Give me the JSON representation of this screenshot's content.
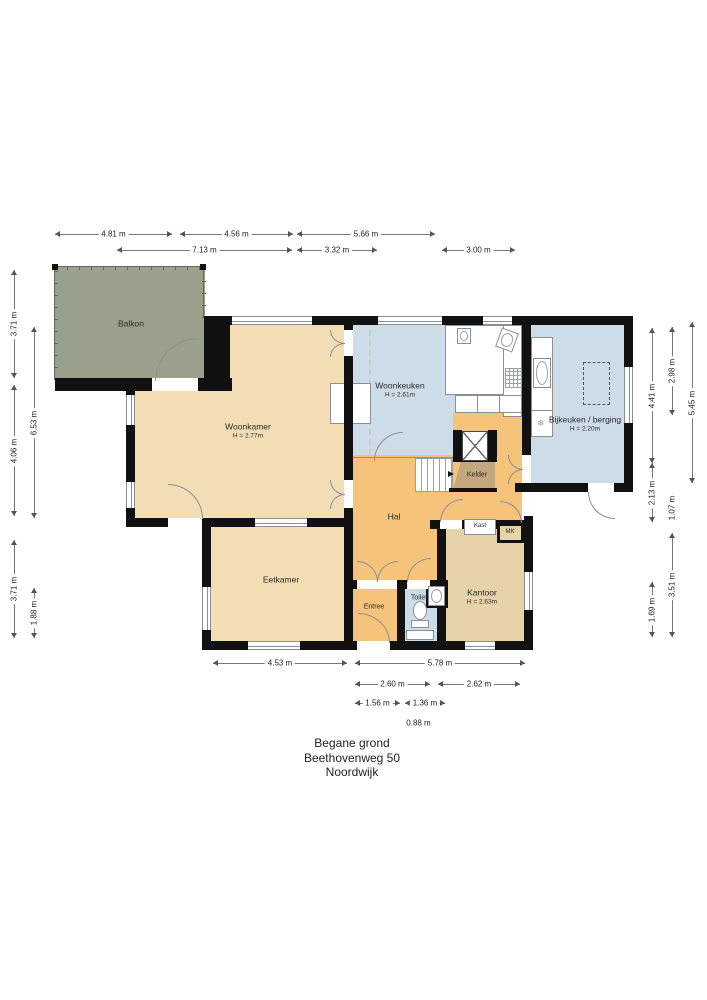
{
  "title": {
    "line1": "Begane grond",
    "line2": "Beethovenweg 50",
    "line3": "Noordwijk"
  },
  "rooms": {
    "balkon": {
      "name": "Balkon"
    },
    "woonkamer": {
      "name": "Woonkamer",
      "height": "H = 2.77m"
    },
    "woonkeuken": {
      "name": "Woonkeuken",
      "height": "H = 2.61m"
    },
    "bijkeuken": {
      "name": "Bijkeuken / berging",
      "height": "H = 2.20m"
    },
    "kelder": {
      "name": "Kelder"
    },
    "hal": {
      "name": "Hal"
    },
    "kast": {
      "name": "Kast"
    },
    "mk": {
      "name": "MK"
    },
    "kantoor": {
      "name": "Kantoor",
      "height": "H = 2.63m"
    },
    "toilet": {
      "name": "Toilet"
    },
    "entree": {
      "name": "Entree"
    },
    "eetkamer": {
      "name": "Eetkamer"
    }
  },
  "dimensions": {
    "top": [
      "4.81 m",
      "4.56 m",
      "5.66 m",
      "7.13 m",
      "3.32 m",
      "3.00 m"
    ],
    "left": [
      "3.71 m",
      "6.53 m",
      "4.06 m",
      "3.71 m",
      "1.88 m"
    ],
    "right": [
      "2.98 m",
      "4.41 m",
      "5.45 m",
      "2.13 m",
      "1.07 m",
      "3.51 m",
      "1.69 m"
    ],
    "bottom": [
      "4.53 m",
      "5.78 m",
      "2.60 m",
      "2.62 m",
      "1.56 m",
      "1.36 m",
      "0.88 m"
    ]
  },
  "icons": {
    "freezer": "❄"
  },
  "colors": {
    "wall": "#111111",
    "balkon": "#9aa08c",
    "living": "#f3ddb5",
    "kitchen": "#ccdde9",
    "hall": "#f5c47a",
    "office": "#e7d3a9",
    "cellar": "#c2a87c",
    "outline": "#8a8f94"
  }
}
